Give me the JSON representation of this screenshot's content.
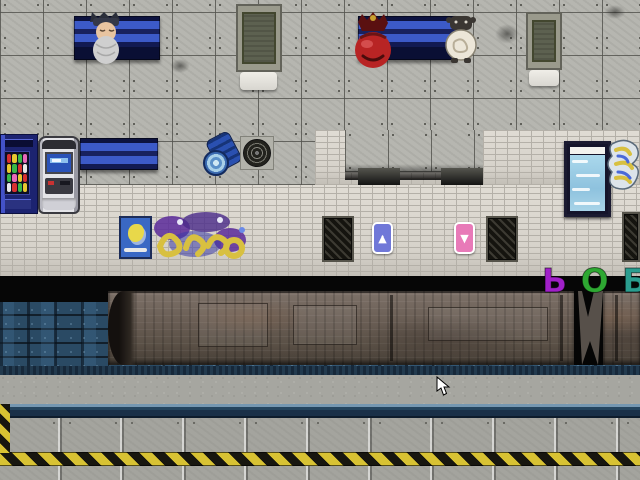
{
  "scene": {
    "name": "subway-platform-game-scene",
    "description": "Top-down RPG subway station: upper platform with benches, machines and characters; tiled wall with graffiti; train on tracks; opposite platform with hazard stripe"
  },
  "graffiti_tag": {
    "letters": [
      {
        "char": "Ь",
        "color": "#a020c8"
      },
      {
        "char": "О",
        "color": "#2ea832"
      },
      {
        "char": "Б",
        "color": "#2a9d8f"
      },
      {
        "char": "И",
        "color": "#256e38"
      }
    ]
  },
  "signs": {
    "up_sign": {
      "glyph_top": "•",
      "glyph_main": "▲",
      "color": "#7078d8"
    },
    "down_sign": {
      "glyph_top": "▬",
      "glyph_main": "▼",
      "color": "#e87ab8"
    }
  },
  "sprites": {
    "sleeping_man": "old man with grey beard lying on bench",
    "red_character": "red-haired figure seated on bench",
    "creature": "small woolly creature",
    "cursor": "white arrow pointer"
  },
  "palette": {
    "floor_gray": "#b6b6b0",
    "tile_wall": "#d8d4cc",
    "bench_blue": "#3c5ac8",
    "track_blue": "#2a4a64",
    "train_rust": "#6c6057",
    "gravel": "#a6a6a0",
    "platform_edge_navy": "#1a3048",
    "hazard_yellow": "#d8c233",
    "black_band": "#060606",
    "vending_blue": "#1c2370",
    "poster_cyan": "#9ecfe6"
  }
}
